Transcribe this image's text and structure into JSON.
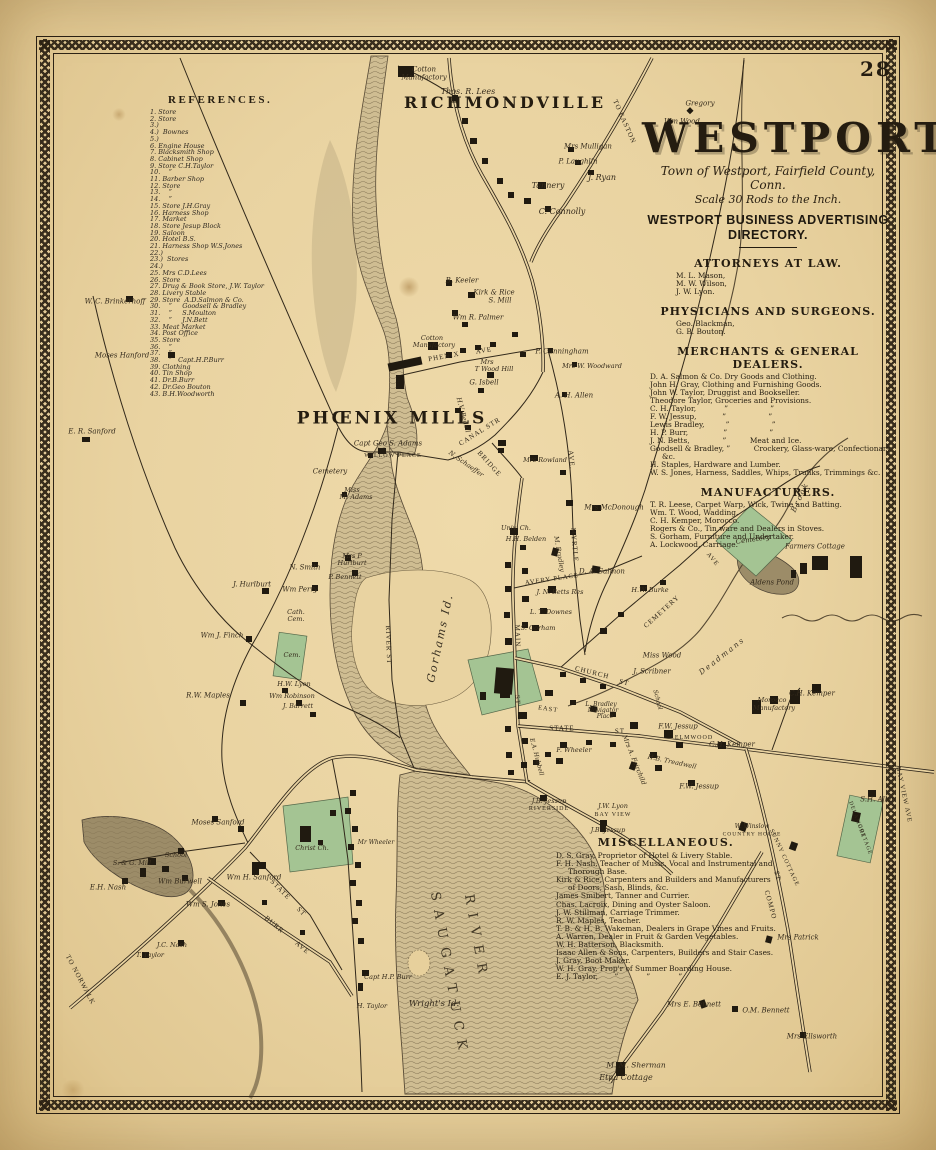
{
  "page": {
    "number": "28"
  },
  "title_block": {
    "title": "WESTPORT",
    "subtitle1": "Town of Westport, Fairfield County, Conn.",
    "subtitle2": "Scale 30 Rods to the Inch.",
    "directory_heading1": "WESTPORT BUSINESS ADVERTISING",
    "directory_heading2": "DIRECTORY."
  },
  "directory": {
    "sections": [
      {
        "heading": "ATTORNEYS AT LAW.",
        "entries": [
          "M. L. Mason,",
          "M. W. Wilson,",
          "J. W. Lyon."
        ]
      },
      {
        "heading": "PHYSICIANS AND SURGEONS.",
        "entries": [
          "Geo. Blackman,",
          "G. B. Bouton."
        ]
      },
      {
        "heading": "MERCHANTS & GENERAL DEALERS.",
        "entries": [
          "D. A. Salmon & Co. Dry Goods and Clothing.",
          "John H. Gray, Clothing and Furnishing Goods.",
          "John W. Taylor, Druggist and Bookseller.",
          "Theodore Taylor, Groceries and Provisions.",
          "C. H. Taylor,            ”                  ”",
          "F. W. Jessup,           ”                  ”",
          "Lewis Bradley,         ”                  ”",
          "H. P. Burr,               ”                  ”",
          "J. N. Betts,              ”          Meat and Ice.",
          "Goodsell & Bradley, ”          Crockery, Glass-ware, Confectionary, &c.",
          "H. Staples, Hardware and Lumber.",
          "W. S. Jones, Harness, Saddles, Whips, Trunks, Trimmings &c."
        ]
      },
      {
        "heading": "MANUFACTURERS.",
        "entries": [
          "T. R. Leese, Carpet Warp, Wick, Twine and Batting.",
          "Wm. T. Wood, Wadding.",
          "C. H. Kemper, Morocco.",
          "Rogers & Co., Tin ware and Dealers in Stoves.",
          "S. Gorham, Furniture and Undertaker.",
          "A. Lockwood, Carriage."
        ]
      }
    ]
  },
  "references": {
    "heading": "REFERENCES.",
    "items": [
      "1. Store",
      "2. Store",
      "3.)",
      "4.)  Bownes",
      "5.)",
      "6. Engine House",
      "7. Blacksmith Shop",
      "8. Cabinet Shop",
      "9. Store C.H.Taylor",
      "10.    ”",
      "11. Barber Shop",
      "12. Store",
      "13.    ”",
      "14.    ”",
      "15. Store J.H.Gray",
      "16. Harness Shop",
      "17. Market",
      "18. Store Jesup Block",
      "19. Saloon",
      "20. Hotel B.S.",
      "21. Harness Shop W.S.Jones",
      "22.)",
      "23.)  Stores",
      "24.)",
      "25. Mrs C.D.Lees",
      "26. Store",
      "27. Drug & Book Store, J.W. Taylor",
      "28. Livery Stable",
      "29. Store  A.D.Salmon & Co.",
      "30.    ”     Goodsell & Bradley",
      "31.    ”     S.Moulton",
      "32.    ”     J.N.Bett",
      "33. Meat Market",
      "34. Post Office",
      "35. Store",
      "36.    ”",
      "37.    ”",
      "38.    ”   Capt.H.P.Burr",
      "39. Clothing",
      "40. Tin Shop",
      "41. Dr.B.Burr",
      "42. Dr.Geo Bouton",
      "43. B.H.Woodworth"
    ]
  },
  "miscellaneous": {
    "heading": "MISCELLANEOUS.",
    "entries": [
      "D. S. Gray, Proprietor of Hotel & Livery Stable.",
      "F. H. Nash, Teacher of Music, Vocal and Instrumental and Thorough Base.",
      "Kirk & Rice, Carpenters and Builders and Manufacturers of Doors, Sash, Blinds, &c.",
      "James Smibert, Tanner and Currier.",
      "Chas. Lacroix, Dining and Oyster Saloon.",
      "J. W. Stillman, Carriage Trimmer.",
      "R. W. Maples, Teacher.",
      "T. B. & H. B. Wakeman, Dealers in Grape Vines and Fruits.",
      "A. Warren, Dealer in Fruit & Garden Vegetables.",
      "W. H. Batterson, Blacksmith.",
      "Isaac Allen & Sons, Carpenters, Builders and Stair Cases.",
      "J. Gray, Boot Maker.",
      "W. H. Gray, Prop'r of Summer Boarding House.",
      "E. J. Taylor,       ”            ”            ”"
    ]
  },
  "map": {
    "colors": {
      "paper": "#e9d3a1",
      "ink": "#2b2113",
      "water": "#cfbd92",
      "green": "#a4c493"
    },
    "labels": [
      {
        "t": "Cotton",
        "x": 424,
        "y": 70,
        "s": 7
      },
      {
        "t": "Manufactory",
        "x": 424,
        "y": 78,
        "s": 7
      },
      {
        "t": "Thos. R. Lees",
        "x": 468,
        "y": 92,
        "s": 8
      },
      {
        "t": "RICHMONDVILLE",
        "x": 505,
        "y": 103,
        "s": 16,
        "c": "big"
      },
      {
        "t": "Mrs Mulligan",
        "x": 588,
        "y": 147,
        "s": 7
      },
      {
        "t": "P. Laughlin",
        "x": 578,
        "y": 162,
        "s": 7
      },
      {
        "t": "Tannery",
        "x": 548,
        "y": 186,
        "s": 8
      },
      {
        "t": "J. Ryan",
        "x": 602,
        "y": 178,
        "s": 8
      },
      {
        "t": "C. Connolly",
        "x": 562,
        "y": 212,
        "s": 8
      },
      {
        "t": "TO EASTON",
        "x": 624,
        "y": 122,
        "s": 7,
        "r": 66,
        "c": "st"
      },
      {
        "t": "Gregory",
        "x": 700,
        "y": 104,
        "s": 7
      },
      {
        "t": "Wm Wood",
        "x": 682,
        "y": 122,
        "s": 7
      },
      {
        "t": "W. C. Brinkerhoff",
        "x": 115,
        "y": 302,
        "s": 7
      },
      {
        "t": "Moses Hanford",
        "x": 122,
        "y": 356,
        "s": 7
      },
      {
        "t": "E. R. Sanford",
        "x": 92,
        "y": 432,
        "s": 7
      },
      {
        "t": "B. Keeler",
        "x": 462,
        "y": 281,
        "s": 7
      },
      {
        "t": "Kirk & Rice",
        "x": 494,
        "y": 293,
        "s": 7
      },
      {
        "t": "S. Mill",
        "x": 500,
        "y": 301,
        "s": 7
      },
      {
        "t": "Wm R. Palmer",
        "x": 478,
        "y": 318,
        "s": 7
      },
      {
        "t": "Cotton",
        "x": 432,
        "y": 338,
        "s": 6.5
      },
      {
        "t": "Manufactory",
        "x": 434,
        "y": 345,
        "s": 6.5
      },
      {
        "t": "PHŒNIX MILLS",
        "x": 392,
        "y": 419,
        "s": 17,
        "c": "big"
      },
      {
        "t": "PHENIX",
        "x": 444,
        "y": 357,
        "s": 7,
        "r": -10,
        "c": "st"
      },
      {
        "t": "AVE",
        "x": 484,
        "y": 351,
        "s": 7,
        "r": -10,
        "c": "st"
      },
      {
        "t": "Mrs",
        "x": 487,
        "y": 362,
        "s": 6.5
      },
      {
        "t": "T Wood Hill",
        "x": 494,
        "y": 369,
        "s": 6.5
      },
      {
        "t": "G. Isbell",
        "x": 484,
        "y": 383,
        "s": 7
      },
      {
        "t": "P. Cunningham",
        "x": 562,
        "y": 352,
        "s": 7
      },
      {
        "t": "Mrs W. Woodward",
        "x": 592,
        "y": 366,
        "s": 6.5
      },
      {
        "t": "A. H. Allen",
        "x": 574,
        "y": 396,
        "s": 7
      },
      {
        "t": "H.V. Bedell",
        "x": 463,
        "y": 415,
        "s": 6.5,
        "r": 75
      },
      {
        "t": "CANAL STR",
        "x": 480,
        "y": 432,
        "s": 7,
        "r": -32,
        "c": "st"
      },
      {
        "t": "BRIDGE",
        "x": 489,
        "y": 464,
        "s": 7,
        "r": 48,
        "c": "st"
      },
      {
        "t": "Capt Geo S. Adams",
        "x": 388,
        "y": 444,
        "s": 7
      },
      {
        "t": "WILLOW PLACE",
        "x": 393,
        "y": 456,
        "s": 6,
        "c": "st"
      },
      {
        "t": "Cemetery",
        "x": 330,
        "y": 472,
        "s": 7
      },
      {
        "t": "N. Schaeffer",
        "x": 466,
        "y": 464,
        "s": 6.5,
        "r": 35
      },
      {
        "t": "Miss",
        "x": 352,
        "y": 490,
        "s": 6.5
      },
      {
        "t": "M. Adams",
        "x": 356,
        "y": 497,
        "s": 6.5
      },
      {
        "t": "Gorhams Id.",
        "x": 440,
        "y": 638,
        "s": 11,
        "r": -78,
        "c": "isl"
      },
      {
        "t": "RIVER ST",
        "x": 388,
        "y": 645,
        "s": 7,
        "r": 88,
        "c": "st"
      },
      {
        "t": "Mrs P",
        "x": 352,
        "y": 556,
        "s": 6.5
      },
      {
        "t": "Hurlburt",
        "x": 352,
        "y": 563,
        "s": 6.5
      },
      {
        "t": "P. Bennett",
        "x": 345,
        "y": 577,
        "s": 6.5
      },
      {
        "t": "N. Smith",
        "x": 305,
        "y": 568,
        "s": 7
      },
      {
        "t": "Wm Perry",
        "x": 300,
        "y": 590,
        "s": 7
      },
      {
        "t": "J. Hurlburt",
        "x": 252,
        "y": 585,
        "s": 7
      },
      {
        "t": "Wm J. Finch",
        "x": 222,
        "y": 636,
        "s": 7
      },
      {
        "t": "Cath.",
        "x": 296,
        "y": 612,
        "s": 6.5
      },
      {
        "t": "Cem.",
        "x": 296,
        "y": 619,
        "s": 6.5
      },
      {
        "t": "Cem.",
        "x": 292,
        "y": 655,
        "s": 6.5
      },
      {
        "t": "R.W. Maples",
        "x": 208,
        "y": 696,
        "s": 7
      },
      {
        "t": "H.W. Lyon",
        "x": 294,
        "y": 684,
        "s": 6.5
      },
      {
        "t": "Wm Robinson",
        "x": 292,
        "y": 696,
        "s": 6.5
      },
      {
        "t": "J. Barrett",
        "x": 298,
        "y": 706,
        "s": 6.5
      },
      {
        "t": "AVERY PLACE",
        "x": 552,
        "y": 580,
        "s": 6.5,
        "r": -8,
        "c": "st"
      },
      {
        "t": "D. A. Salmon",
        "x": 602,
        "y": 572,
        "s": 7
      },
      {
        "t": "J. N. Betts Res",
        "x": 560,
        "y": 592,
        "s": 6.5
      },
      {
        "t": "L. T. Downes",
        "x": 551,
        "y": 612,
        "s": 6.5
      },
      {
        "t": "S. Gorham",
        "x": 538,
        "y": 628,
        "s": 6.5
      },
      {
        "t": "MAIN",
        "x": 517,
        "y": 636,
        "s": 7,
        "r": 88,
        "c": "st"
      },
      {
        "t": "ST",
        "x": 517,
        "y": 700,
        "s": 7,
        "r": 88,
        "c": "st"
      },
      {
        "t": "CHURCH",
        "x": 592,
        "y": 673,
        "s": 7,
        "r": 14,
        "c": "st"
      },
      {
        "t": "ST",
        "x": 624,
        "y": 683,
        "s": 7,
        "r": 14,
        "c": "st"
      },
      {
        "t": "CEMETERY",
        "x": 662,
        "y": 612,
        "s": 7,
        "r": -42,
        "c": "st"
      },
      {
        "t": "MYRTLE",
        "x": 574,
        "y": 545,
        "s": 7,
        "r": 85,
        "c": "st"
      },
      {
        "t": "AVE.",
        "x": 571,
        "y": 460,
        "s": 7,
        "r": 85,
        "c": "st"
      },
      {
        "t": "Mrs McDonough",
        "x": 614,
        "y": 508,
        "s": 7
      },
      {
        "t": "Mrs Rowland",
        "x": 545,
        "y": 460,
        "s": 6.5
      },
      {
        "t": "Univ. Ch.",
        "x": 516,
        "y": 528,
        "s": 6.5
      },
      {
        "t": "H.H. Belden",
        "x": 526,
        "y": 539,
        "s": 6.5
      },
      {
        "t": "M. Bradley",
        "x": 559,
        "y": 554,
        "s": 6.5,
        "r": 80
      },
      {
        "t": "H.W. Burke",
        "x": 650,
        "y": 590,
        "s": 6.5
      },
      {
        "t": "Miss Wood",
        "x": 662,
        "y": 656,
        "s": 7
      },
      {
        "t": "J. Scribner",
        "x": 652,
        "y": 672,
        "s": 7
      },
      {
        "t": "School",
        "x": 657,
        "y": 700,
        "s": 6,
        "r": 75
      },
      {
        "t": "Deadmans",
        "x": 722,
        "y": 656,
        "s": 7.5,
        "r": -38,
        "c": "isl"
      },
      {
        "t": "Brook",
        "x": 800,
        "y": 497,
        "s": 7.5,
        "r": -65,
        "c": "isl"
      },
      {
        "t": "Cemetery",
        "x": 753,
        "y": 540,
        "s": 7,
        "r": -8
      },
      {
        "t": "Farmers Cottage",
        "x": 815,
        "y": 547,
        "s": 7
      },
      {
        "t": "Aldens Pond",
        "x": 772,
        "y": 583,
        "s": 7
      },
      {
        "t": "AVE",
        "x": 712,
        "y": 560,
        "s": 6.5,
        "r": 50,
        "c": "st"
      },
      {
        "t": "Morocco",
        "x": 772,
        "y": 700,
        "s": 6.5
      },
      {
        "t": "Manufactory",
        "x": 774,
        "y": 708,
        "s": 6.5
      },
      {
        "t": "C.H. Kemper",
        "x": 812,
        "y": 694,
        "s": 7
      },
      {
        "t": "C.H. Kemper",
        "x": 732,
        "y": 745,
        "s": 7
      },
      {
        "t": "ELMWOOD",
        "x": 694,
        "y": 738,
        "s": 6,
        "c": "st"
      },
      {
        "t": "F.W. Jessup",
        "x": 678,
        "y": 727,
        "s": 7
      },
      {
        "t": "F.W. Jessup",
        "x": 699,
        "y": 787,
        "s": 7
      },
      {
        "t": "H.B. Treadwell",
        "x": 672,
        "y": 762,
        "s": 6.5,
        "r": 12
      },
      {
        "t": "Mrs A. Fairchild",
        "x": 634,
        "y": 760,
        "s": 6.5,
        "r": 68
      },
      {
        "t": "STATE",
        "x": 562,
        "y": 729,
        "s": 7,
        "c": "st"
      },
      {
        "t": "ST",
        "x": 620,
        "y": 732,
        "s": 7,
        "c": "st"
      },
      {
        "t": "EAST",
        "x": 548,
        "y": 710,
        "s": 6.5,
        "r": 8,
        "c": "st"
      },
      {
        "t": "L. Bradley",
        "x": 601,
        "y": 705,
        "s": 6
      },
      {
        "t": "Navigator",
        "x": 603,
        "y": 711,
        "s": 6
      },
      {
        "t": "Place",
        "x": 605,
        "y": 717,
        "s": 6
      },
      {
        "t": "E.A. Hubbell",
        "x": 536,
        "y": 757,
        "s": 6,
        "r": 75
      },
      {
        "t": "F. Wheeler",
        "x": 574,
        "y": 750,
        "s": 6.5
      },
      {
        "t": "J.B. Jessup",
        "x": 549,
        "y": 801,
        "s": 6.5
      },
      {
        "t": "RIVERSIDE",
        "x": 549,
        "y": 809,
        "s": 6,
        "c": "st"
      },
      {
        "t": "J.W. Lyon",
        "x": 613,
        "y": 806,
        "s": 6.5
      },
      {
        "t": "BAY VIEW",
        "x": 613,
        "y": 815,
        "s": 6,
        "c": "st"
      },
      {
        "t": "J.B. Jessup",
        "x": 608,
        "y": 830,
        "s": 6.5
      },
      {
        "t": "COMPO",
        "x": 770,
        "y": 905,
        "s": 7,
        "r": 75,
        "c": "st"
      },
      {
        "t": "ST",
        "x": 777,
        "y": 876,
        "s": 7,
        "r": 75,
        "c": "st"
      },
      {
        "t": "SUNNY COTTAGE",
        "x": 784,
        "y": 858,
        "s": 6,
        "r": 65,
        "c": "st"
      },
      {
        "t": "Mrs Patrick",
        "x": 798,
        "y": 938,
        "s": 7
      },
      {
        "t": "W. Winslow",
        "x": 752,
        "y": 827,
        "s": 6
      },
      {
        "t": "COUNTRY HOUSE",
        "x": 752,
        "y": 835,
        "s": 5.5,
        "c": "st"
      },
      {
        "t": "S.H. Allen",
        "x": 878,
        "y": 800,
        "s": 7
      },
      {
        "t": "BAY VIEW AVE",
        "x": 903,
        "y": 795,
        "s": 6.5,
        "r": 78,
        "c": "st"
      },
      {
        "t": "DELAMORE",
        "x": 856,
        "y": 820,
        "s": 5.5,
        "r": 70,
        "c": "st"
      },
      {
        "t": "COTTAGE",
        "x": 864,
        "y": 840,
        "s": 5.5,
        "r": 70,
        "c": "st"
      },
      {
        "t": "Mrs Ellsworth",
        "x": 812,
        "y": 1037,
        "s": 7
      },
      {
        "t": "O.M. Bennett",
        "x": 766,
        "y": 1011,
        "s": 7
      },
      {
        "t": "Mrs E. Bennett",
        "x": 694,
        "y": 1005,
        "s": 7
      },
      {
        "t": "M. M. Sherman",
        "x": 636,
        "y": 1065,
        "s": 7.5
      },
      {
        "t": "Etna Cottage",
        "x": 626,
        "y": 1078,
        "s": 8
      },
      {
        "t": "SAUGATUCK",
        "x": 449,
        "y": 975,
        "s": 13,
        "r": 80,
        "c": "riv"
      },
      {
        "t": "RIVER",
        "x": 476,
        "y": 938,
        "s": 13,
        "r": 80,
        "c": "riv"
      },
      {
        "t": "Capt H.P. Burr",
        "x": 388,
        "y": 977,
        "s": 6.5
      },
      {
        "t": "H. Taylor",
        "x": 372,
        "y": 1006,
        "s": 6.5
      },
      {
        "t": "Wright's Id.",
        "x": 434,
        "y": 1004,
        "s": 8.5,
        "c": "isl2"
      },
      {
        "t": "Moses Sanford",
        "x": 218,
        "y": 823,
        "s": 7
      },
      {
        "t": "School",
        "x": 176,
        "y": 855,
        "s": 6.5
      },
      {
        "t": "S. & G. Mill",
        "x": 132,
        "y": 863,
        "s": 6.5
      },
      {
        "t": "E.H. Nash",
        "x": 108,
        "y": 888,
        "s": 7
      },
      {
        "t": "Wm Burwell",
        "x": 180,
        "y": 882,
        "s": 7
      },
      {
        "t": "Wm H. Sanford",
        "x": 254,
        "y": 878,
        "s": 7
      },
      {
        "t": "Wm S. Jones",
        "x": 208,
        "y": 905,
        "s": 7
      },
      {
        "t": "J.C. Nash",
        "x": 172,
        "y": 945,
        "s": 6.5
      },
      {
        "t": "T. Taylor",
        "x": 150,
        "y": 955,
        "s": 6.5
      },
      {
        "t": "Christ Ch.",
        "x": 312,
        "y": 848,
        "s": 6.5
      },
      {
        "t": "Mr Wheeler",
        "x": 376,
        "y": 843,
        "s": 6
      },
      {
        "t": "TO NORWALK",
        "x": 80,
        "y": 980,
        "s": 7,
        "r": 62,
        "c": "st"
      },
      {
        "t": "STATE",
        "x": 280,
        "y": 890,
        "s": 7,
        "r": 45,
        "c": "st"
      },
      {
        "t": "ST",
        "x": 301,
        "y": 912,
        "s": 7,
        "r": 45,
        "c": "st"
      },
      {
        "t": "BURR",
        "x": 274,
        "y": 925,
        "s": 7,
        "r": 40,
        "c": "st"
      },
      {
        "t": "AVE",
        "x": 302,
        "y": 948,
        "s": 7,
        "r": 40,
        "c": "st"
      }
    ]
  }
}
